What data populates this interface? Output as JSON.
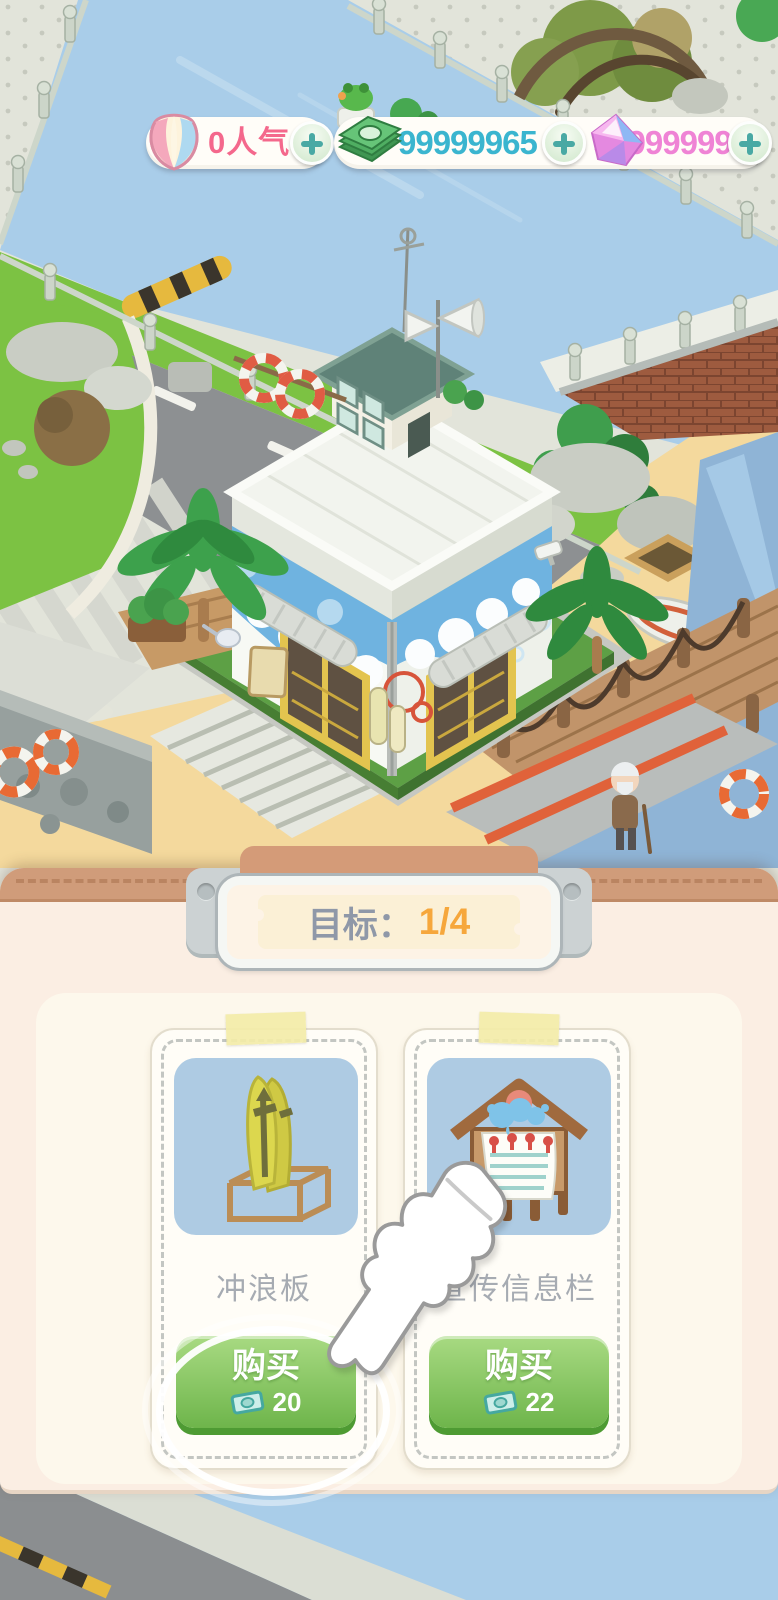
{
  "currency_bar": {
    "popularity": {
      "icon": "shell-icon",
      "value": "0人气"
    },
    "cash": {
      "icon": "money-icon",
      "value": "99999965"
    },
    "diamond": {
      "icon": "gem-icon",
      "value": "99999999"
    }
  },
  "goal": {
    "label": "目标：",
    "progress": "1/4"
  },
  "shop": {
    "items": [
      {
        "name": "冲浪板",
        "buy_label": "购买",
        "price": "20",
        "currency_icon": "money-icon"
      },
      {
        "name": "宣传信息栏",
        "buy_label": "购买",
        "price": "22",
        "currency_icon": "money-icon"
      }
    ]
  },
  "scene": {
    "description": "seaside-town-surf-shop",
    "npc": "old-man"
  },
  "colors": {
    "buy_button_green": "#6eb54b",
    "coin_text": "#3ab5cf",
    "gem_text": "#ef83d5",
    "popularity_text": "#f4688c",
    "goal_progress_orange": "#f6a73c",
    "sheet_cream": "#fbeee3",
    "water_blue": "#a9cde9",
    "sand_yellow": "#f4d99d"
  }
}
